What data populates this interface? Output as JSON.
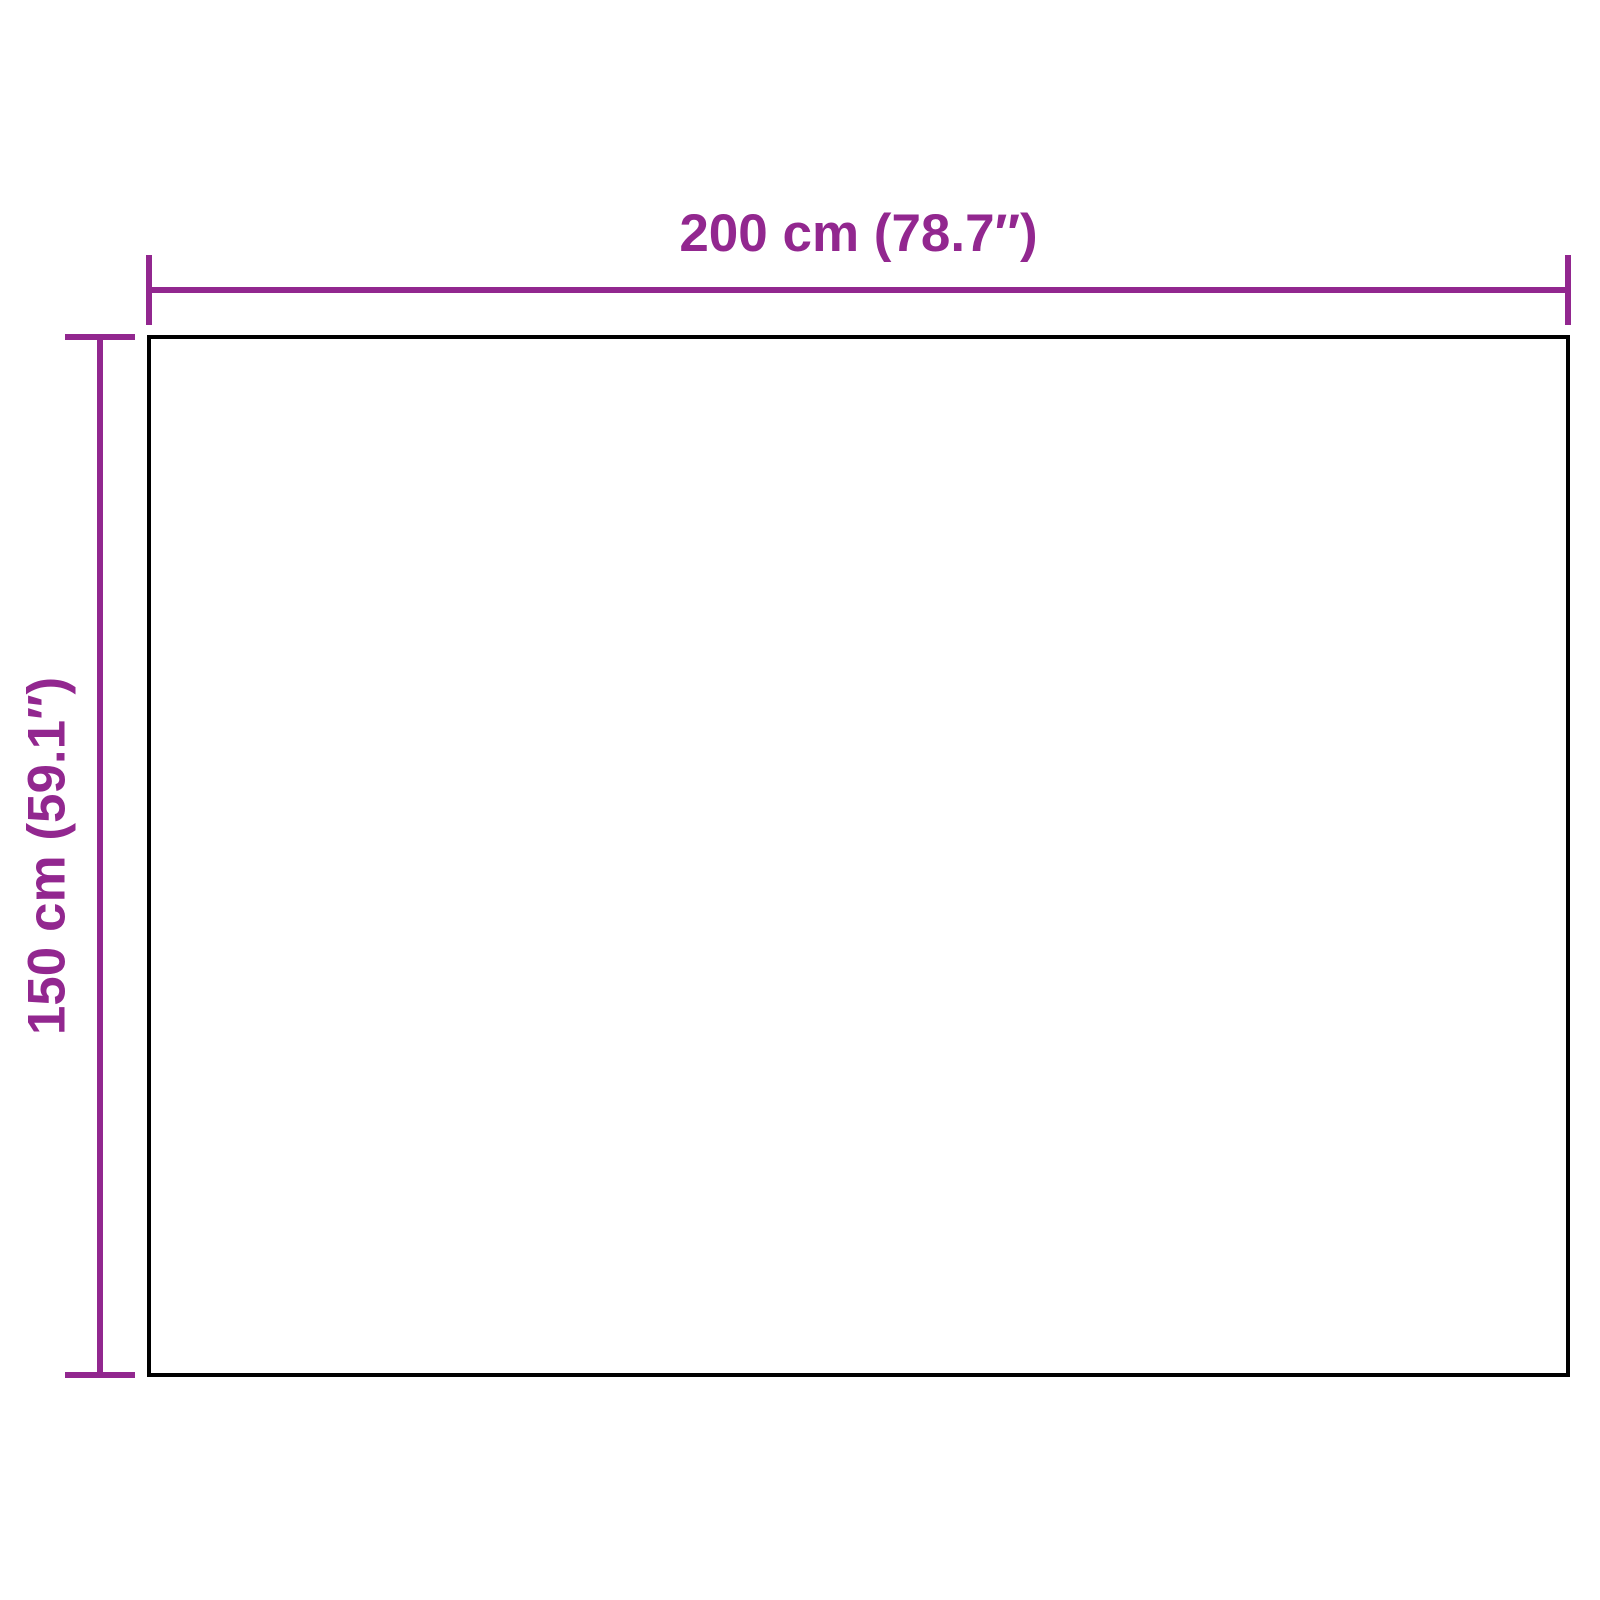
{
  "dimensions": {
    "width": {
      "label": "200 cm (78.7″)",
      "cm": 200,
      "inches": 78.7
    },
    "height": {
      "label": "150 cm (59.1″)",
      "cm": 150,
      "inches": 59.1
    }
  },
  "colors": {
    "dimension_lines": "#92278F",
    "outline": "#000000",
    "background": "#FFFFFF"
  }
}
